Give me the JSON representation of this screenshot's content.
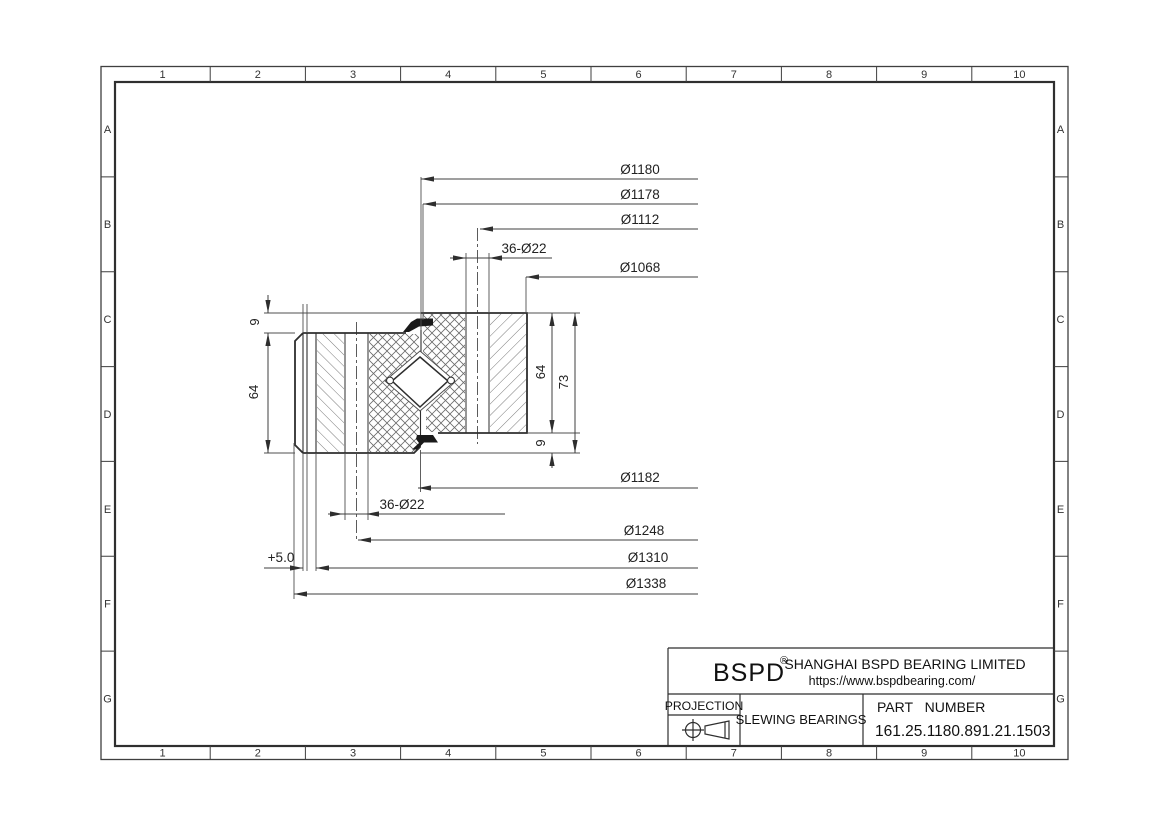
{
  "drawing": {
    "grid": {
      "cols": [
        "1",
        "2",
        "3",
        "4",
        "5",
        "6",
        "7",
        "8",
        "9",
        "10"
      ],
      "rows": [
        "A",
        "B",
        "C",
        "D",
        "E",
        "F",
        "G"
      ]
    },
    "dims": {
      "top": [
        "Ø1180",
        "Ø1178",
        "Ø1112",
        "36-Ø22",
        "Ø1068"
      ],
      "bottom": [
        "Ø1182",
        "36-Ø22",
        "Ø1248",
        "Ø1310",
        "Ø1338"
      ],
      "offset": "+5.0",
      "vertical": {
        "left_gap": "9",
        "left_height": "64",
        "right_height": "64",
        "total_height": "73",
        "right_gap": "9"
      }
    },
    "title_block": {
      "logo": "BSPD",
      "registered": "®",
      "company": "SHANGHAI BSPD BEARING LIMITED",
      "website": "https://www.bspdbearing.com/",
      "projection_label": "PROJECTION",
      "product_type": "SLEWING BEARINGS",
      "part_number_label": "PART NUMBER",
      "part_number": "161.25.1180.891.21.1503"
    },
    "colors": {
      "line": "#3a3a3a",
      "hatch": "#6b6b6b",
      "seal": "#1a1a1a",
      "background": "#ffffff"
    }
  }
}
